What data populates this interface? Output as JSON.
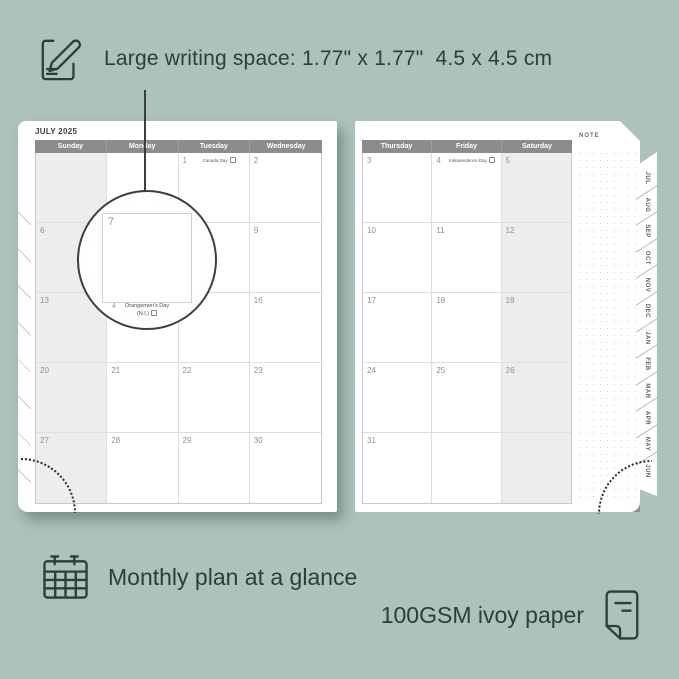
{
  "colors": {
    "background": "#adc2ba",
    "ink": "#2c3e38",
    "header_bar": "#8c8c8c",
    "weekend_fill": "#ededeb",
    "page_shadow": "rgba(80,101,94,0.55)"
  },
  "annotations": {
    "top": {
      "icon": "pencil-note-icon",
      "text": "Large writing space: 1.77\" x 1.77\"  4.5 x 4.5 cm"
    },
    "bottom_left": {
      "icon": "calendar-icon",
      "text": "Monthly plan at a glance"
    },
    "bottom_right": {
      "icon": "paper-sheet-icon",
      "text": "100GSM ivoy paper"
    }
  },
  "planner": {
    "title": "JULY 2025",
    "note_label": "NOTE",
    "left_page": {
      "weekend_col": 0,
      "headers": [
        "Sunday",
        "Monday",
        "Tuesday",
        "Wednesday"
      ],
      "rows": [
        [
          {
            "day": ""
          },
          {
            "day": ""
          },
          {
            "day": "1",
            "holiday": "Canada Day",
            "badge": true
          },
          {
            "day": "2"
          }
        ],
        [
          {
            "day": "6"
          },
          {
            "day": "7"
          },
          {
            "day": "8"
          },
          {
            "day": "9"
          }
        ],
        [
          {
            "day": "13"
          },
          {
            "day": "14"
          },
          {
            "day": "15"
          },
          {
            "day": "16"
          }
        ],
        [
          {
            "day": "20"
          },
          {
            "day": "21"
          },
          {
            "day": "22"
          },
          {
            "day": "23"
          }
        ],
        [
          {
            "day": "27"
          },
          {
            "day": "28"
          },
          {
            "day": "29"
          },
          {
            "day": "30"
          }
        ]
      ]
    },
    "right_page": {
      "weekend_col": 2,
      "headers": [
        "Thursday",
        "Friday",
        "Saturday"
      ],
      "rows": [
        [
          {
            "day": "3"
          },
          {
            "day": "4",
            "holiday": "Independence Day",
            "badge": true
          },
          {
            "day": "5"
          }
        ],
        [
          {
            "day": "10"
          },
          {
            "day": "11"
          },
          {
            "day": "12"
          }
        ],
        [
          {
            "day": "17"
          },
          {
            "day": "18"
          },
          {
            "day": "19"
          }
        ],
        [
          {
            "day": "24"
          },
          {
            "day": "25"
          },
          {
            "day": "26"
          }
        ],
        [
          {
            "day": "31"
          },
          {
            "day": ""
          },
          {
            "day": ""
          }
        ]
      ]
    },
    "tabs": [
      "JUL",
      "AUG",
      "SEP",
      "OCT",
      "NOV",
      "DEC",
      "JAN",
      "FEB",
      "MAR",
      "APR",
      "MAY",
      "JUN"
    ],
    "magnifier": {
      "day": "7",
      "partial_day": "4",
      "holiday_line1": "Orangemen's Day",
      "holiday_line2": "(N.I.)",
      "badge": true
    }
  }
}
